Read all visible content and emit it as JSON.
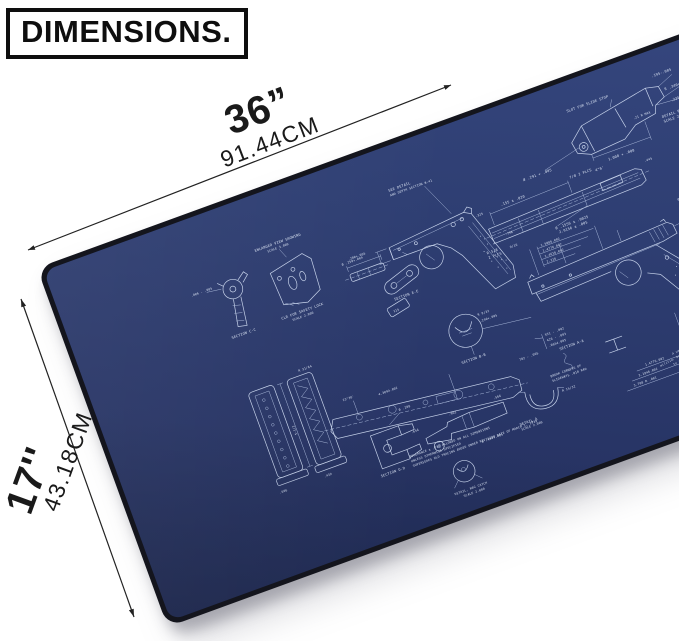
{
  "header": {
    "title": "DIMENSIONS."
  },
  "measurements": {
    "width_inches": "36”",
    "width_cm": "91.44CM",
    "height_inches": "17''",
    "height_cm": "43.18CM"
  },
  "colors": {
    "pad_navy": "#2c3c6f",
    "blueprint_line": "#c6d2ea",
    "pad_edge": "#14151d",
    "annotation_black": "#1a1a1a"
  },
  "pad": {
    "ann": {
      "slot_slide_stop": "SLOT FOR SLIDE STOP",
      "d195": ".195-.005",
      "r340": "R .340+.010",
      "d235": ".235 + .090",
      "detail_p": "DETAIL P",
      "scale2": "SCALE 2.000",
      "d1008": "1.008 + .008",
      "a46": "4°6'",
      "dia291": "Ø .291 + .005",
      "d21rmax": ".21 R MAX",
      "see_detail": "SEE DETAIL",
      "depth_section": "AND DEPTH SECTION W-41",
      "enlarged": "ENLARGED VIEW SHOWING",
      "scale3": "SCALE 3.000",
      "clr_safety": "CLR FOR SAFETY LOCK",
      "section_cc": "SECTION C-C",
      "section_ee": "SECTION E-E",
      "section_aa": "SECTION A-A",
      "section_bb": "SECTION B-B",
      "section_dd": "SECTION D-D",
      "d006": ".006 - .005",
      "d155": ".155 ± .020",
      "plcs78": "7/8  2 PLCS",
      "dia1556": "Ø .1556 ± .0025",
      "d29156": "2.9156 ± .005",
      "r58": "R 5/8",
      "plcs2": "2 PLCS",
      "dia250": "Ø .250+.004",
      "dia200": ".200+.005",
      "d325": ".325",
      "d796": ".796",
      "dim1": "1.5886.002",
      "dim2": "1.4776.002",
      "dim3": "1.4616.002",
      "dim4": "2.216",
      "dim5": "3.1946.002",
      "dim6": "3.708 R .001",
      "dia092": "Ø .092",
      "d108": ".108 + .015",
      "d5half": "5-1/2",
      "r3164": "R 31/64",
      "d606": ".606",
      "d439": ".439",
      "d4309": "4.3094.002",
      "dia288": "Ø .288",
      "d656": ".656",
      "d962": ".962",
      "d566": ".566",
      "break1": "BREAK CORNERS OF",
      "break2": "SLIDEWAYS .010 RAD",
      "detail_a": "DETAIL A",
      "dia494": "Ø .494+.005",
      "r1532": "R 15/32",
      "d551": "551 - .002",
      "d426": "426 - .003",
      "d0654": ".0654.005",
      "d782": "782 - .005",
      "detail_mag": "DETAIL, MAG CATCH",
      "d115": "115",
      "r932": "R 9/32",
      "d240": ".240+.005",
      "d445": ".445",
      "f916": "9/16",
      "dia042": "Ø .042",
      "r78": "R 7/8",
      "a2336": "23°36'",
      "tol1": "TOLERANCE ± .010 ALLOWED ON ALL DIMENSIONS",
      "tol2": "UNLESS OTHERWISE SPECIFIED",
      "tol3": "SUPERSEDES OLD TRACING ADDED UNDER REVISION DATE OF MARCH 1, 1939",
      "note1": "A well regulated",
      "note2": "militia, being necessary",
      "note3": "to the security of",
      "note4": "a free state."
    }
  }
}
